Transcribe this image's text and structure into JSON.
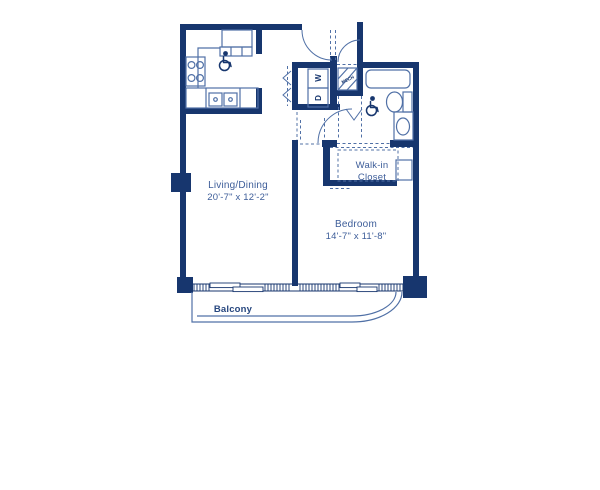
{
  "plan": {
    "colors": {
      "wall": "#17366e",
      "line": "#5070a6",
      "text": "#3d5d99",
      "balcony_text": "#27477f"
    },
    "rooms": {
      "living": {
        "name": "Living/Dining",
        "dims": "20'-7\" x 12'-2\""
      },
      "bedroom": {
        "name": "Bedroom",
        "dims": "14'-7\" x 11'-8\""
      },
      "walk_in_closet": {
        "line1": "Walk-in",
        "line2": "Closet"
      },
      "balcony": {
        "name": "Balcony"
      }
    },
    "appliances": {
      "washer": "W",
      "dryer": "D",
      "mech": "MECH"
    },
    "fixtures": [
      "range",
      "refrigerator",
      "double-sink",
      "bathtub",
      "toilet",
      "vanity-sink",
      "stacked-washer-dryer",
      "wheelchair-accessible-symbol"
    ]
  }
}
